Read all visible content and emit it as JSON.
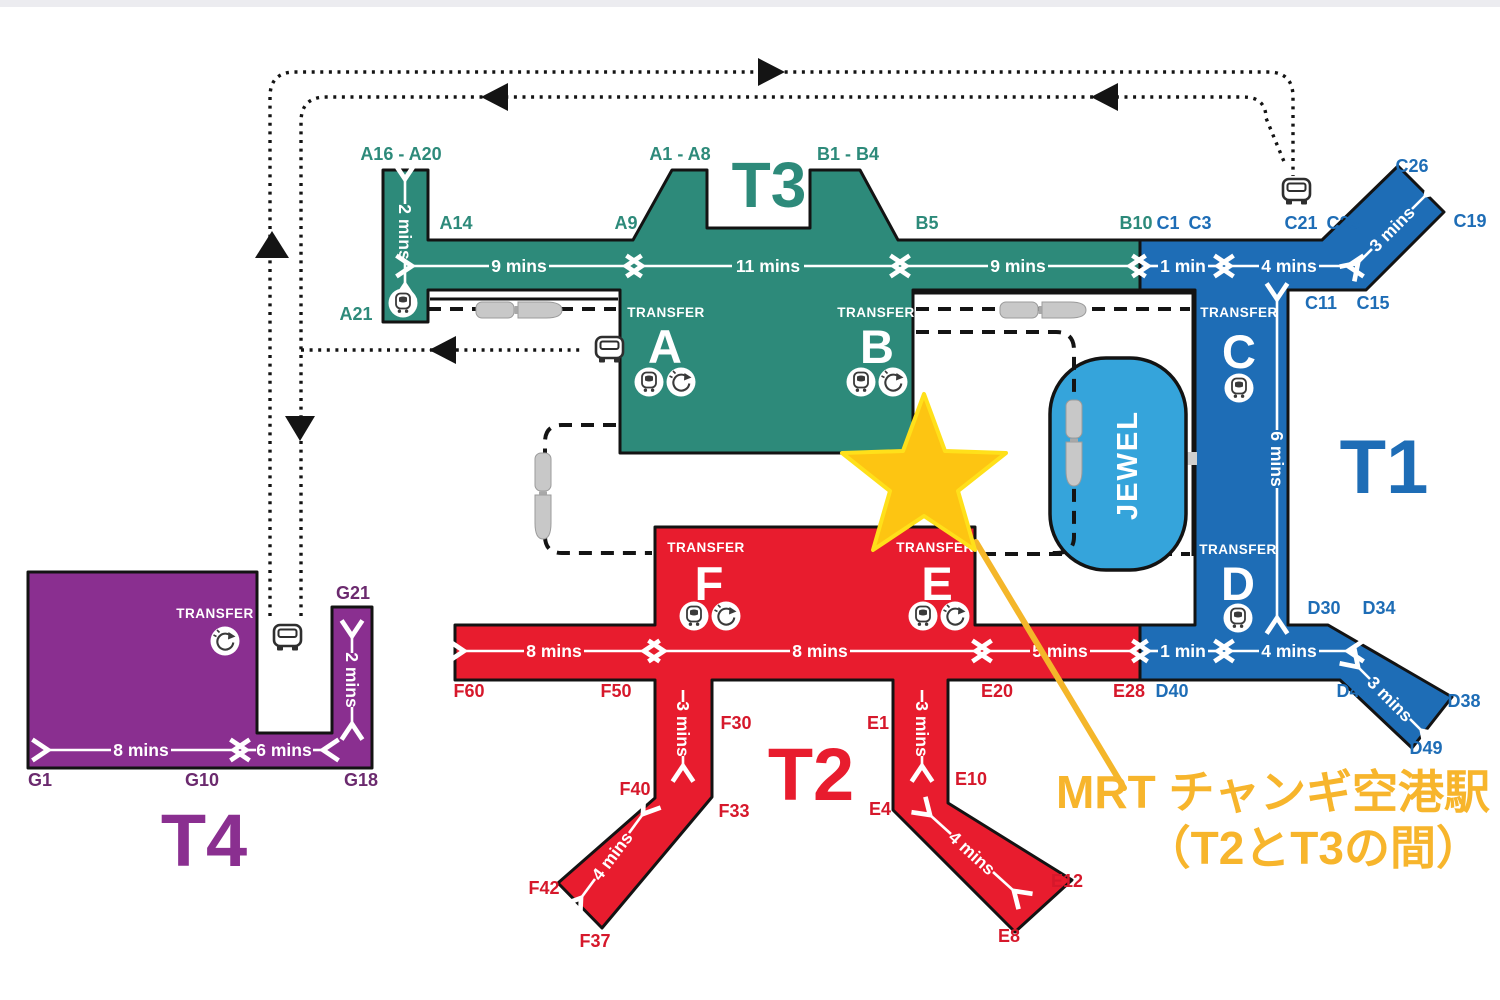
{
  "map": {
    "terminals": {
      "t1": "T1",
      "t2": "T2",
      "t3": "T3",
      "t4": "T4"
    },
    "jewel_label": "JEWEL",
    "transfer_label": "TRANSFER",
    "transfer_points": {
      "a": "A",
      "b": "B",
      "c": "C",
      "d": "D",
      "e": "E",
      "f": "F"
    },
    "gates": {
      "a16_a20": "A16 - A20",
      "a14": "A14",
      "a9": "A9",
      "a1_a8": "A1 - A8",
      "a21": "A21",
      "b1_b4": "B1 - B4",
      "b5": "B5",
      "b10": "B10",
      "c1": "C1",
      "c3": "C3",
      "c21": "C21",
      "c23": "C23",
      "c26": "C26",
      "c19": "C19",
      "c11": "C11",
      "c15": "C15",
      "d30": "D30",
      "d34": "D34",
      "d40": "D40",
      "d46": "D46",
      "d38": "D38",
      "d49": "D49",
      "e20": "E20",
      "e1": "E1",
      "e10": "E10",
      "e4": "E4",
      "e12": "E12",
      "e8": "E8",
      "e28": "E28",
      "f60": "F60",
      "f50": "F50",
      "f30": "F30",
      "f40": "F40",
      "f33": "F33",
      "f42": "F42",
      "f37": "F37",
      "g21": "G21",
      "g1": "G1",
      "g10": "G10",
      "g18": "G18"
    },
    "walk_times": {
      "t3_arm": "2 mins",
      "t3_a": "9 mins",
      "t3_ab": "11 mins",
      "t3_b": "9 mins",
      "t1_top_1min": "1 min",
      "t1_top_4mins": "4 mins",
      "t1_arm_top": "3 mins",
      "t1_mid_6mins": "6 mins",
      "t1_bot_1min": "1 min",
      "t1_bot_4mins": "4 mins",
      "t1_arm_bot": "3 mins",
      "t2_f_8mins": "8 mins",
      "t2_fe_8mins": "8 mins",
      "t2_e_5mins": "5 mins",
      "t2_f_arm_3mins": "3 mins",
      "t2_f_arm_4mins": "4 mins",
      "t2_e_arm_3mins": "3 mins",
      "t2_e_arm_4mins": "4 mins",
      "t4_8mins": "8 mins",
      "t4_6mins": "6 mins",
      "t4_arm_2mins": "2 mins"
    },
    "annotation": {
      "line1": "MRT チャンギ空港駅",
      "line2": "（T2とT3の間）"
    },
    "icons": {
      "skytrain_circle": "skytrain-icon",
      "shuttle_circle": "transfer-shuttle-icon",
      "bus": "bus-icon",
      "skytrain_vehicle": "skytrain-vehicle",
      "station_marker": "star-icon"
    },
    "colors": {
      "t3_teal": "#2d8a7a",
      "t1_blue": "#1e6db6",
      "t2_red": "#e81c2e",
      "t4_purple": "#8a2f90",
      "jewel_blue": "#35a4db",
      "star_gold": "#fdc512",
      "annotation_orange": "#f7b52c",
      "route_black": "#141414"
    }
  }
}
